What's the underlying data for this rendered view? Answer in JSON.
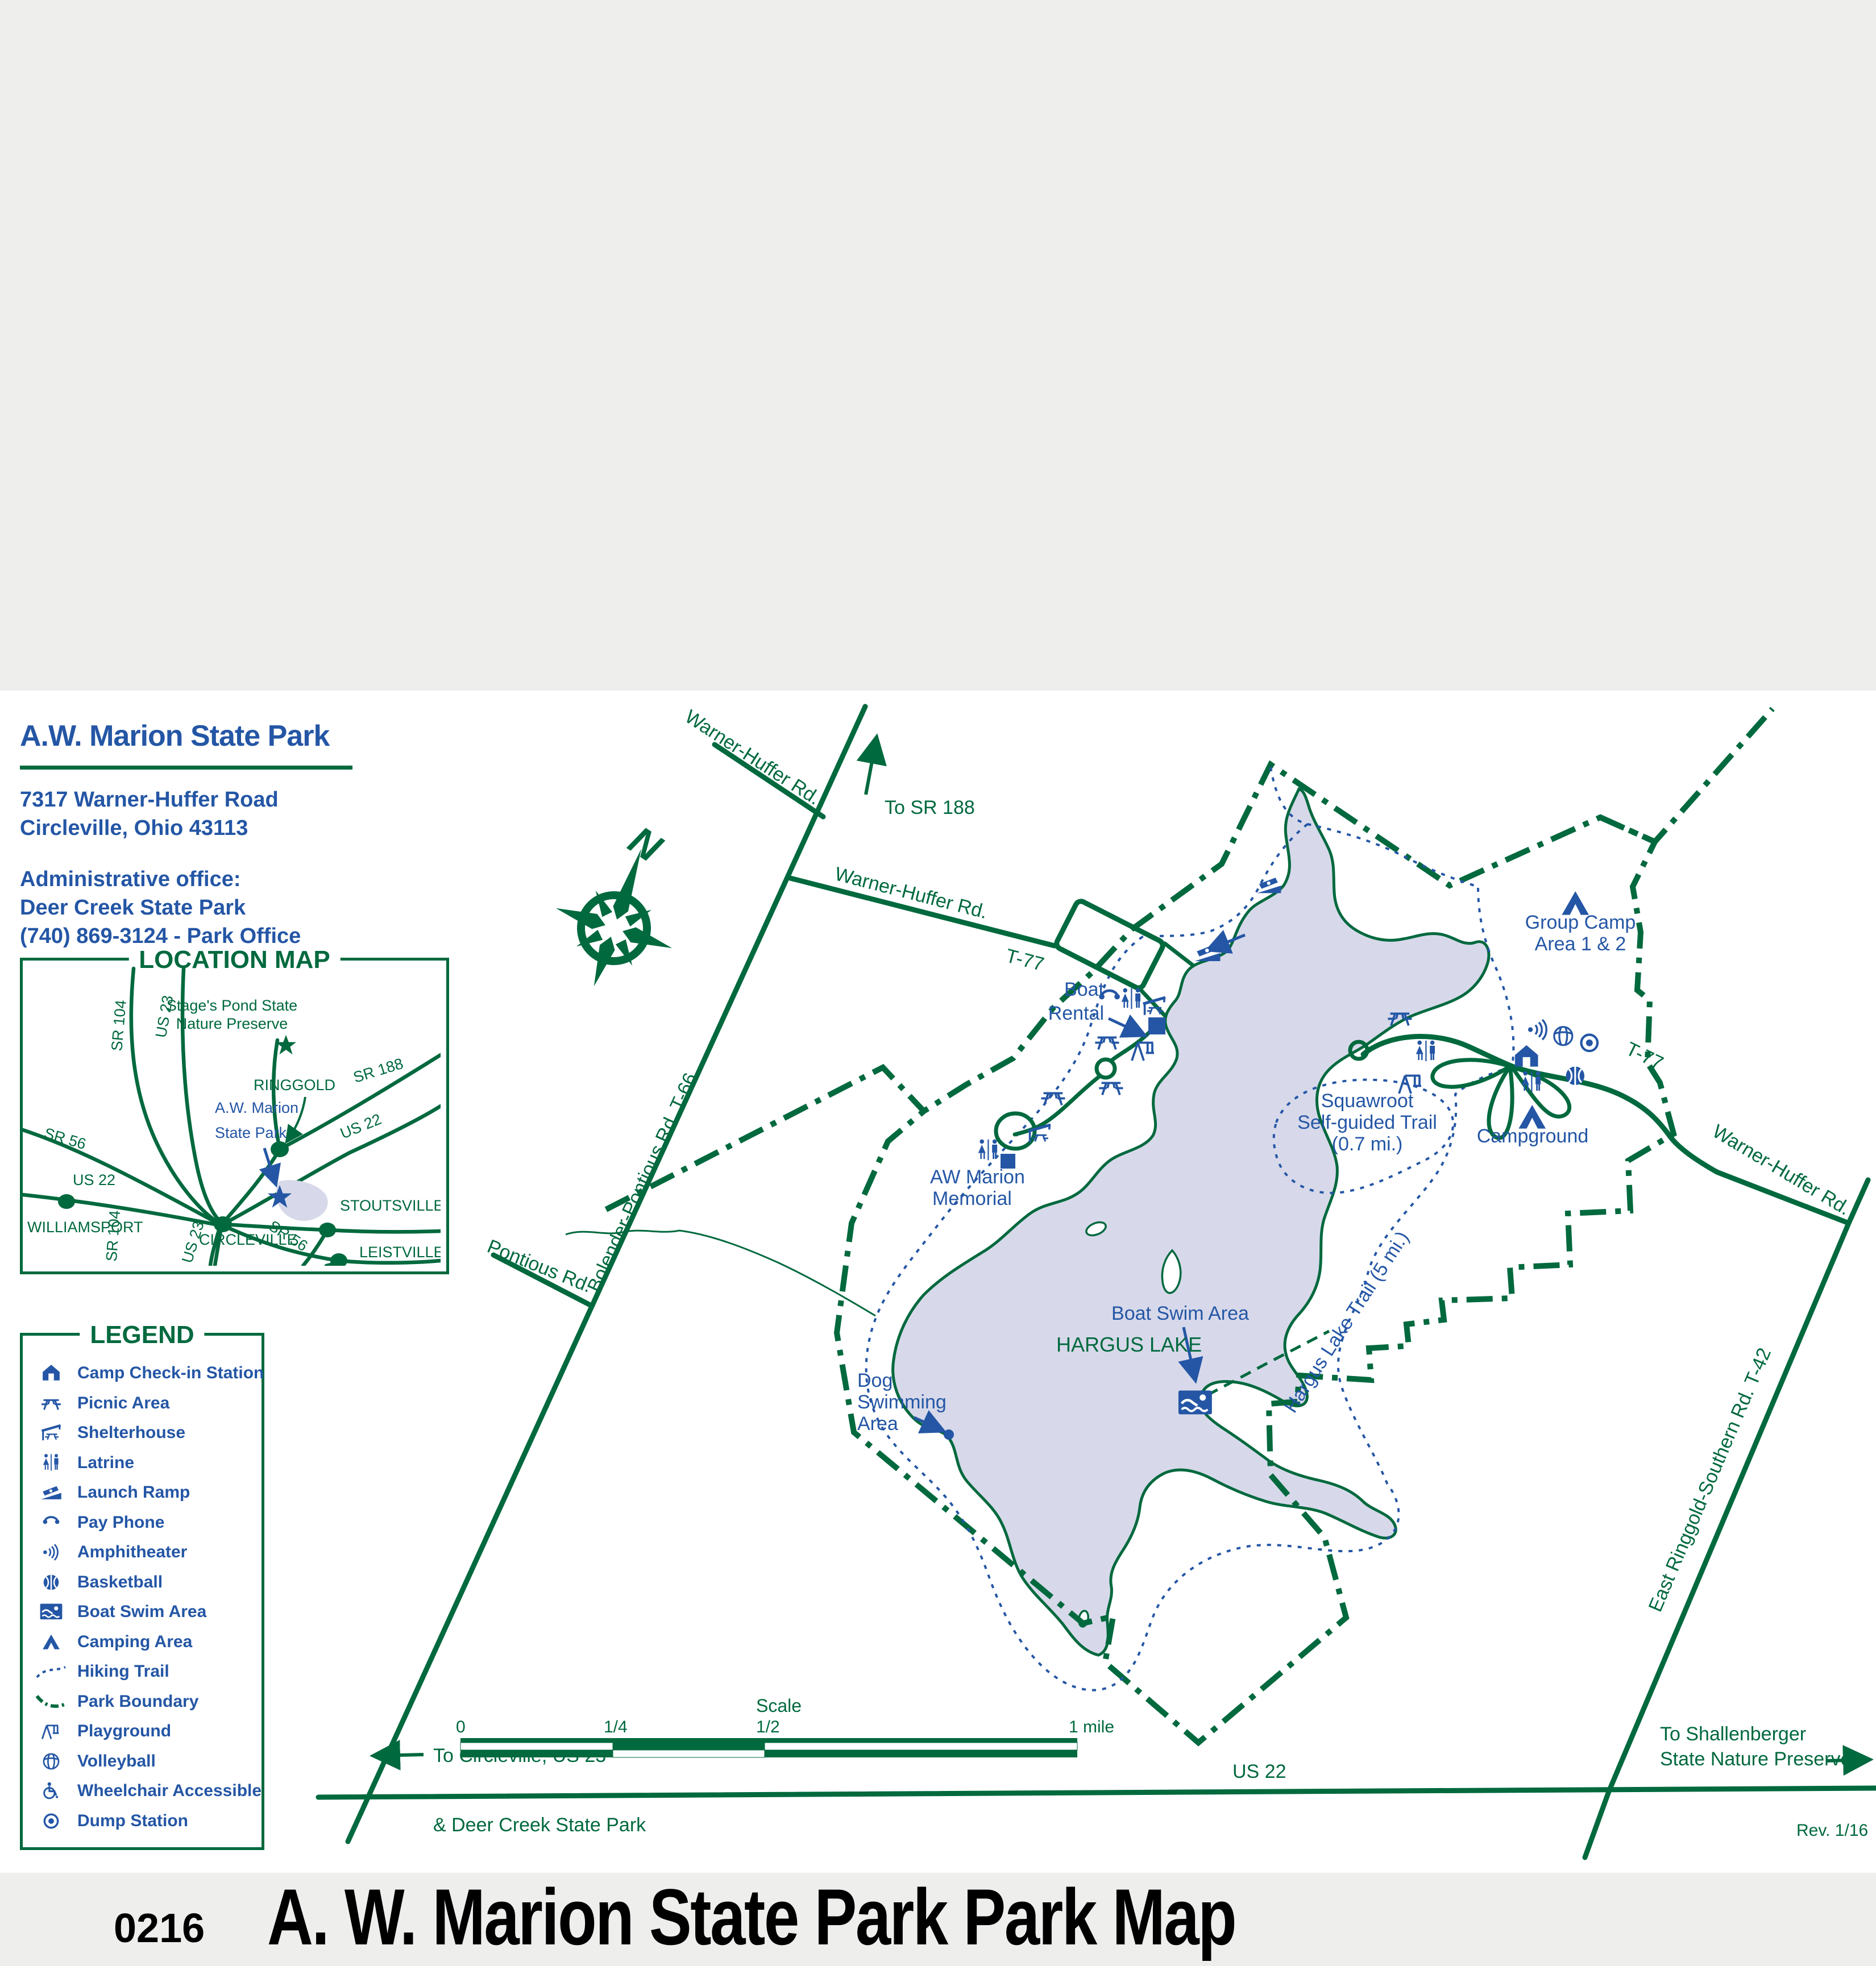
{
  "page": {
    "title_code": "0216",
    "title": "A. W. Marion State Park  Park Map",
    "revision": "Rev. 1/16"
  },
  "colors": {
    "green": "#00693e",
    "blue": "#2456a5",
    "lake_fill": "#d7d9ea",
    "band_gray": "#eeeeec"
  },
  "header": {
    "park_name": "A.W. Marion State Park",
    "address_line1": "7317 Warner-Huffer Road",
    "address_line2": "Circleville, Ohio 43113",
    "admin_heading": "Administrative office:",
    "admin_line1": "Deer Creek State Park",
    "admin_line2": "(740) 869-3124 - Park Office"
  },
  "location_map": {
    "title": "LOCATION MAP",
    "labels": {
      "stage_1": "Stage's Pond State",
      "stage_2": "Nature Preserve",
      "ringgold": "RINGGOLD",
      "sr188": "SR 188",
      "sr104_n": "SR 104",
      "us23_n": "US 23",
      "awm_1": "A.W. Marion",
      "awm_2": "State Park",
      "us22_e": "US 22",
      "sr56_w": "SR 56",
      "stoutsville": "STOUTSVILLE",
      "circleville": "CIRCLEVILLE",
      "williamsport": "WILLIAMSPORT",
      "us22_w": "US 22",
      "sr104_s": "SR 104",
      "us23_s": "US 23",
      "sr56_s": "SR 56",
      "leistville": "LEISTVILLE"
    }
  },
  "legend": {
    "title": "LEGEND",
    "items": [
      {
        "icon": "camp-checkin-icon",
        "label": "Camp Check-in Station"
      },
      {
        "icon": "picnic-area-icon",
        "label": "Picnic Area"
      },
      {
        "icon": "shelterhouse-icon",
        "label": "Shelterhouse"
      },
      {
        "icon": "latrine-icon",
        "label": "Latrine"
      },
      {
        "icon": "launch-ramp-icon",
        "label": "Launch Ramp"
      },
      {
        "icon": "pay-phone-icon",
        "label": "Pay Phone"
      },
      {
        "icon": "amphitheater-icon",
        "label": "Amphitheater"
      },
      {
        "icon": "basketball-icon",
        "label": "Basketball"
      },
      {
        "icon": "boat-swim-icon",
        "label": "Boat Swim Area"
      },
      {
        "icon": "camping-icon",
        "label": "Camping Area"
      },
      {
        "icon": "hiking-trail-line",
        "label": "Hiking Trail"
      },
      {
        "icon": "park-boundary-line",
        "label": "Park Boundary"
      },
      {
        "icon": "playground-icon",
        "label": "Playground"
      },
      {
        "icon": "volleyball-icon",
        "label": "Volleyball"
      },
      {
        "icon": "wheelchair-icon",
        "label": "Wheelchair Accessible"
      },
      {
        "icon": "dump-station-icon",
        "label": "Dump Station"
      }
    ]
  },
  "map": {
    "north": "N",
    "labels": {
      "to_sr188": "To SR 188",
      "warner_huffer_top": "Warner-Huffer Rd.",
      "warner_huffer_mid": "Warner-Huffer Rd.",
      "t77_west": "T-77",
      "bolender": "Bolender-Pontious Rd.   T-66",
      "pontious": "Pontious Rd.",
      "boat_rental_1": "Boat",
      "boat_rental_2": "Rental",
      "aw_memorial_1": "AW Marion",
      "aw_memorial_2": "Memorial",
      "dog_1": "Dog",
      "dog_2": "Swimming",
      "dog_3": "Area",
      "hargus_lake": "HARGUS LAKE",
      "boat_swim": "Boat Swim Area",
      "squawroot_1": "Squawroot",
      "squawroot_2": "Self-guided Trail",
      "squawroot_3": "(0.7 mi.)",
      "hargus_trail": "Hargus Lake Trail (5 mi.)",
      "group_camp_1": "Group Camp",
      "group_camp_2": "Area 1 & 2",
      "campground": "Campground",
      "t77_east": "T-77",
      "warner_huffer_east": "Warner-Huffer Rd.",
      "east_ringgold": "East Ringgold-Southern Rd.    T-42",
      "us22": "US 22",
      "to_circleville": "To Circleville, US 23",
      "deer_creek": "& Deer Creek State Park",
      "shallenberger_1": "To Shallenberger",
      "shallenberger_2": "State Nature Preserve"
    },
    "scale_bar": {
      "title": "Scale",
      "tick_0": "0",
      "tick_quarter": "1/4",
      "tick_half": "1/2",
      "tick_mile": "1 mile"
    }
  }
}
